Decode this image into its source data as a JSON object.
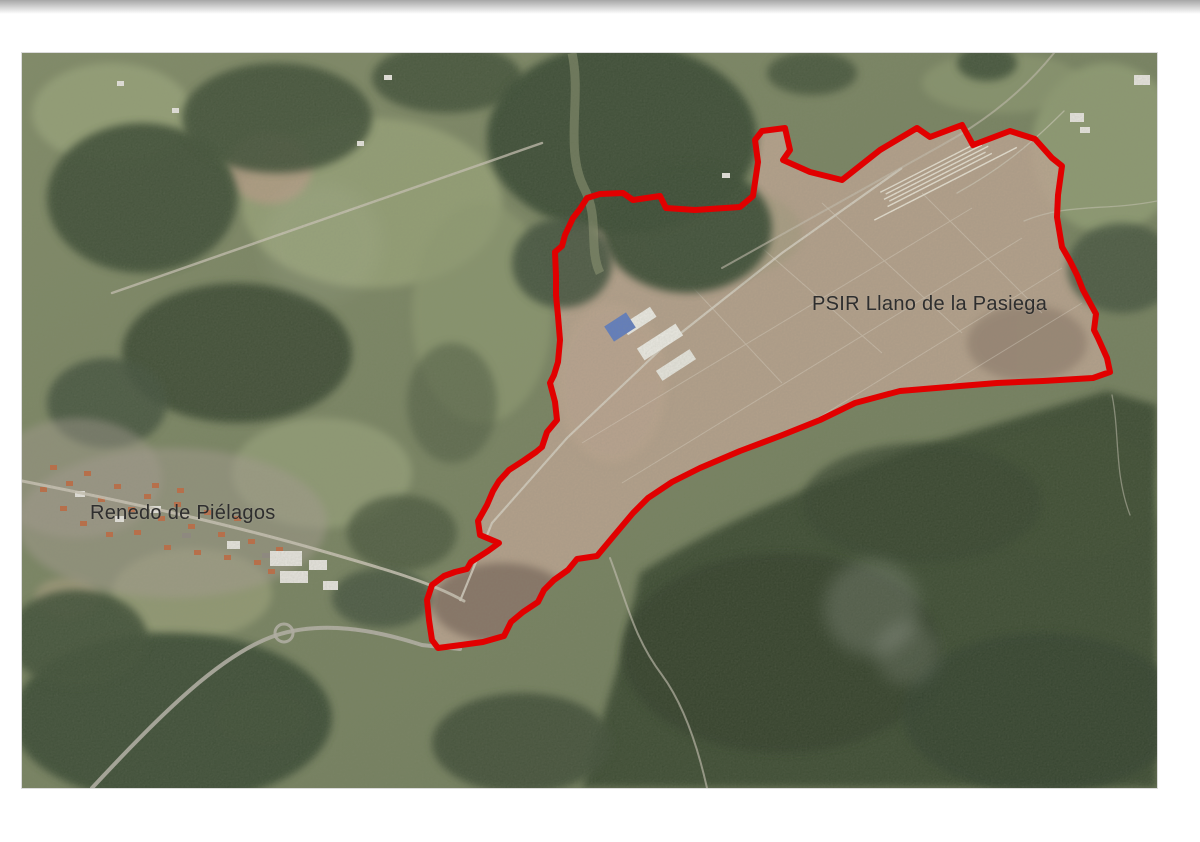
{
  "map": {
    "kind": "satellite-aerial-photo",
    "labels": {
      "psir": "PSIR Llano de la Pasiega",
      "renedo": "Renedo de Piélagos"
    },
    "label_color": "#2e2e2e",
    "overlay": {
      "boundary_color": "#e10000",
      "boundary_stroke_width": 6,
      "polygon_points": "565,145 578,141 601,140 611,147 638,143 644,155 673,157 718,154 731,143 736,109 733,87 740,78 763,75 768,97 761,107 788,119 820,127 858,97 895,75 908,84 940,72 951,92 988,78 1013,86 1030,105 1040,113 1036,142 1035,164 1040,194 1048,208 1055,222 1061,237 1074,261 1072,277 1076,285 1085,305 1088,319 1071,325 1021,328 975,330 938,333 878,338 833,350 798,367 758,383 718,398 678,415 650,429 626,445 611,460 590,485 575,503 555,506 546,517 532,527 522,537 516,549 501,559 489,569 482,583 461,589 439,592 416,595 410,587 407,567 405,547 410,532 422,523 433,519 445,516 449,509 466,498 477,490 458,482 456,468 465,452 471,438 477,428 487,417 501,408 514,399 520,394 525,379 535,367 533,349 528,330 532,322 536,309 538,287 536,263 534,242 534,223 533,199 540,193 543,182 551,165 558,156"
    }
  }
}
